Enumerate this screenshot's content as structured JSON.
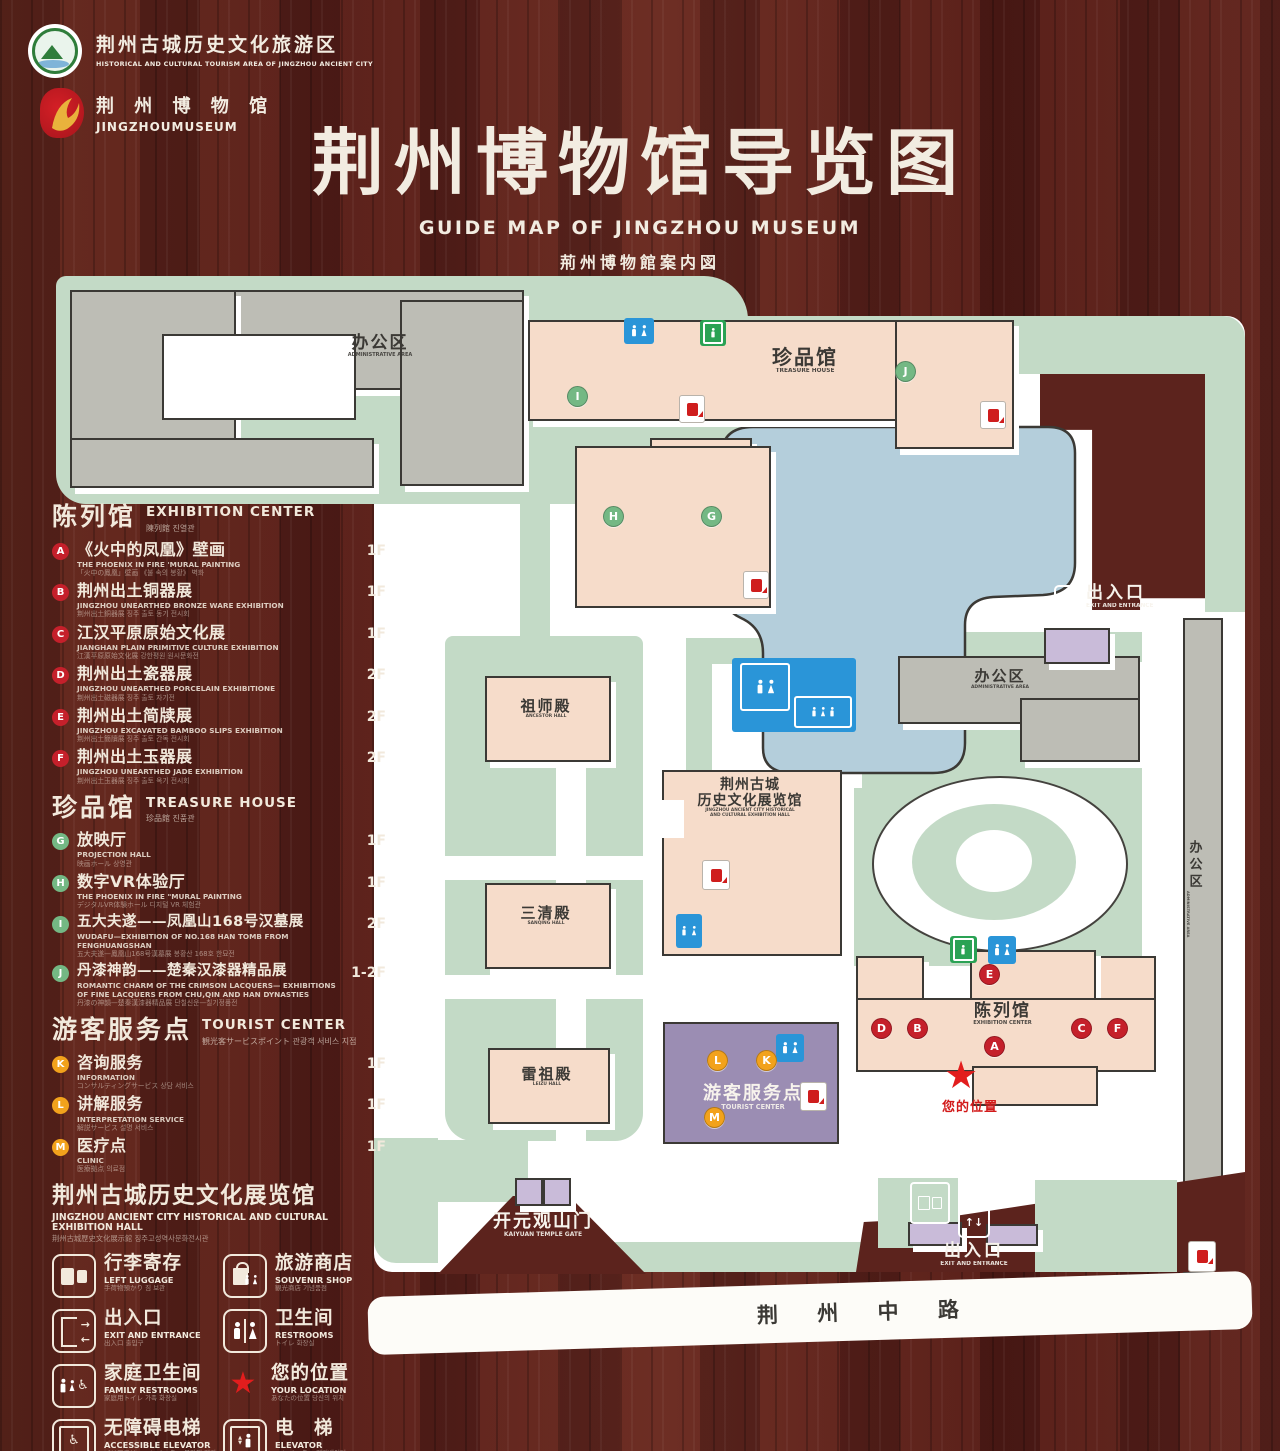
{
  "header": {
    "logo1": {
      "cn": "荆州古城历史文化旅游区",
      "en": "HISTORICAL AND CULTURAL TOURISM AREA OF JINGZHOU ANCIENT CITY"
    },
    "logo2": {
      "cn": "荆 州 博 物 馆",
      "en": "JINGZHOUMUSEUM"
    },
    "title_cn": "荆州博物馆导览图",
    "title_en": "GUIDE MAP OF JINGZHOU MUSEUM",
    "title_jp": "荊州博物館案内図",
    "title_kr": "징주박물관 안내도"
  },
  "legend": {
    "sections": [
      {
        "title_cn": "陈列馆",
        "title_en": "EXHIBITION CENTER",
        "title_sub": "陳列館  진열관",
        "items": [
          {
            "letter": "A",
            "cn": "《火中的凤凰》壁画",
            "en": "THE PHOENIX IN FIRE 'MURAL PAINTING",
            "sub": "「火中の鳳凰」壁画 《불 속의 봉황》 벽화",
            "floor": "1F"
          },
          {
            "letter": "B",
            "cn": "荆州出土铜器展",
            "en": "JINGZHOU UNEARTHED BRONZE WARE EXHIBITION",
            "sub": "荆州出土銅器展  징주 출토 동기 전시회",
            "floor": "1F"
          },
          {
            "letter": "C",
            "cn": "江汉平原原始文化展",
            "en": "JIANGHAN PLAIN PRIMITIVE CULTURE EXHIBITION",
            "sub": "江漢平原原始文化展  강한평원 원시문화전",
            "floor": "1F"
          },
          {
            "letter": "D",
            "cn": "荆州出土瓷器展",
            "en": "JINGZHOU UNEARTHED PORCELAIN EXHIBITIONE",
            "sub": "荆州出土磁器展  징주 출토 자기전",
            "floor": "2F"
          },
          {
            "letter": "E",
            "cn": "荆州出土简牍展",
            "en": "JINGZHOU EXCAVATED BAMBOO SLIPS EXHIBITION",
            "sub": "荆州出土簡牘展  징주 출토 간독 전시회",
            "floor": "2F"
          },
          {
            "letter": "F",
            "cn": "荆州出土玉器展",
            "en": "JINGZHOU UNEARTHED JADE EXHIBITION",
            "sub": "荆州出土玉器展  징주 출토 옥기 전시회",
            "floor": "2F"
          }
        ]
      },
      {
        "title_cn": "珍品馆",
        "title_en": "TREASURE HOUSE",
        "title_sub": "珍品館  진품관",
        "items": [
          {
            "letter": "G",
            "cn": "放映厅",
            "en": "PROJECTION HALL",
            "sub": "映画ホール  상영관",
            "floor": "1F"
          },
          {
            "letter": "H",
            "cn": "数字VR体验厅",
            "en": "THE PHOENIX IN FIRE \"MURAL PAINTING",
            "sub": "デジタルVR体験ホール  디지털 VR 체험관",
            "floor": "1F"
          },
          {
            "letter": "I",
            "cn": "五大夫遂——凤凰山168号汉墓展",
            "en": "WUDAFU—EXHIBITION OF NO.168 HAN TOMB FROM FENGHUANGSHAN",
            "sub": "五大夫遂—鳳凰山168号漢墓展  봉황산 168호 한묘전",
            "floor": "2F"
          },
          {
            "letter": "J",
            "cn": "丹漆神韵——楚秦汉漆器精品展",
            "en": "ROMANTIC CHARM OF THE CRIMSON LACQUERS— EXHIBITIONS OF FINE LACQUERS FROM CHU,QIN AND HAN DYNASTIES",
            "sub": "丹漆の神韻—楚秦漢漆器精品展  단칠신운—칠기정품전",
            "floor": "1-2F"
          }
        ]
      },
      {
        "title_cn": "游客服务点",
        "title_en": "TOURIST CENTER",
        "title_sub": "観光客サービスポイント  관광객 서비스 지점",
        "items": [
          {
            "letter": "K",
            "cn": "咨询服务",
            "en": "INFORMATION",
            "sub": "コンサルティングサービス  상담 서비스",
            "floor": "1F"
          },
          {
            "letter": "L",
            "cn": "讲解服务",
            "en": "INTERPRETATION SERVICE",
            "sub": "解説サービス  설명 서비스",
            "floor": "1F"
          },
          {
            "letter": "M",
            "cn": "医疗点",
            "en": "CLINIC",
            "sub": "医療拠点  의료점",
            "floor": "1F"
          }
        ]
      }
    ],
    "hall_section": {
      "cn": "荆州古城历史文化展览馆",
      "en": "JINGZHOU ANCIENT CITY HISTORICAL AND CULTURAL EXHIBITION HALL",
      "sub": "荆州古城歴史文化展示館   징주고성역사문화전시관"
    },
    "facilities": [
      {
        "icon": "left-luggage-icon",
        "cn": "行李寄存",
        "en": "LEFT LUGGAGE",
        "sub": "手荷物預かり  짐 보관"
      },
      {
        "icon": "souvenir-shop-icon",
        "cn": "旅游商店",
        "en": "SOUVENIR SHOP",
        "sub": "観光商店  기념품점"
      },
      {
        "icon": "exit-entrance-icon",
        "cn": "出入口",
        "en": "EXIT AND ENTRANCE",
        "sub": "出入口  출입구"
      },
      {
        "icon": "restrooms-icon",
        "cn": "卫生间",
        "en": "RESTROOMS",
        "sub": "トイレ  화장실"
      },
      {
        "icon": "family-restrooms-icon",
        "cn": "家庭卫生间",
        "en": "FAMILY RESTROOMS",
        "sub": "家庭用トイレ  가족 화장실"
      },
      {
        "icon": "your-location-icon",
        "cn": "您的位置",
        "en": "YOUR LOCATION",
        "sub": "あなたの位置  당신의 위치"
      },
      {
        "icon": "accessible-elevator-icon",
        "cn": "无障碍电梯",
        "en": "ACCESSIBLE ELEVATOR",
        "sub": "バリアフリーエレベーター  무장애 엘리베이터"
      },
      {
        "icon": "elevator-icon",
        "cn": "电　梯",
        "en": "ELEVATOR",
        "sub": "エレベーター  엘리베이터"
      },
      {
        "icon": "display-area-swatch",
        "cn": "展示区域",
        "en": "DISPLAY AREA",
        "sub": "展示エリア  전시 구역"
      },
      {
        "icon": "office-area-swatch",
        "cn": "办公区域",
        "en": "OFFICE AREA",
        "sub": "オフィスエリア  사무 구역"
      }
    ]
  },
  "map": {
    "labels": {
      "admin_nw": {
        "cn": "办公区",
        "en": "ADMINISTRATIVE AREA"
      },
      "treasure_house": {
        "cn": "珍品馆",
        "en": "TREASURE HOUSE"
      },
      "admin_e": {
        "cn": "办公区",
        "en": "ADMINISTRATIVE AREA"
      },
      "admin_far_e": {
        "cn": "办公区",
        "en": "ADMINISTRATIVE AREA"
      },
      "ancestor_hall": {
        "cn": "祖师殿",
        "en": "ANCESTOR HALL"
      },
      "history_hall": {
        "cn1": "荆州古城",
        "cn2": "历史文化展览馆",
        "en1": "JINGZHOU ANCIENT CITY HISTORICAL",
        "en2": "AND CULTURAL EXHIBITION HALL"
      },
      "sanqing_hall": {
        "cn": "三清殿",
        "en": "SANQING HALL"
      },
      "leizu_hall": {
        "cn": "雷祖殿",
        "en": "LEIZU HALL"
      },
      "tourist_center": {
        "cn": "游客服务点",
        "en": "TOURIST CENTER"
      },
      "exhibition_center": {
        "cn": "陈列馆",
        "en": "EXHIBITION CENTER"
      },
      "kaiyuan_gate": {
        "cn": "开元观山门",
        "en": "KAIYUAN TEMPLE GATE"
      },
      "exit_east": {
        "cn": "出入口",
        "en": "EXIT AND ENTRANCE"
      },
      "exit_south": {
        "cn": "出入口",
        "en": "EXIT AND ENTRANCE"
      },
      "your_location": {
        "cn": "您的位置"
      },
      "road": {
        "cn": "荆 州 中 路"
      }
    },
    "markers": {
      "A": "A",
      "B": "B",
      "C": "C",
      "D": "D",
      "E": "E",
      "F": "F",
      "G": "G",
      "H": "H",
      "I": "I",
      "J": "J",
      "K": "K",
      "L": "L",
      "M": "M"
    },
    "icons": {
      "restroom": "restroom-icon",
      "family_restroom": "family-restroom-icon",
      "elevator": "elevator-icon",
      "facility_red": "fire-hydrant-icon",
      "exit": "exit-entrance-icon",
      "entrance_arrows": "up-down-arrows-icon",
      "luggage": "left-luggage-icon",
      "your_location": "star-icon"
    }
  },
  "colors": {
    "marker_red": "#c5202b",
    "marker_green": "#74b884",
    "marker_orange": "#f2a21c",
    "display_area": "#f6dcca",
    "office_area": "#bdbdb5",
    "map_green": "#c3dac6",
    "lake_blue": "#b4cedb",
    "tourist_purple": "#9b8db3",
    "gate_lavender": "#c9bbd9",
    "restroom_blue": "#2a95d8",
    "elevator_green": "#2aa254",
    "star_red": "#e21d1d",
    "wood": "#5e251e"
  }
}
